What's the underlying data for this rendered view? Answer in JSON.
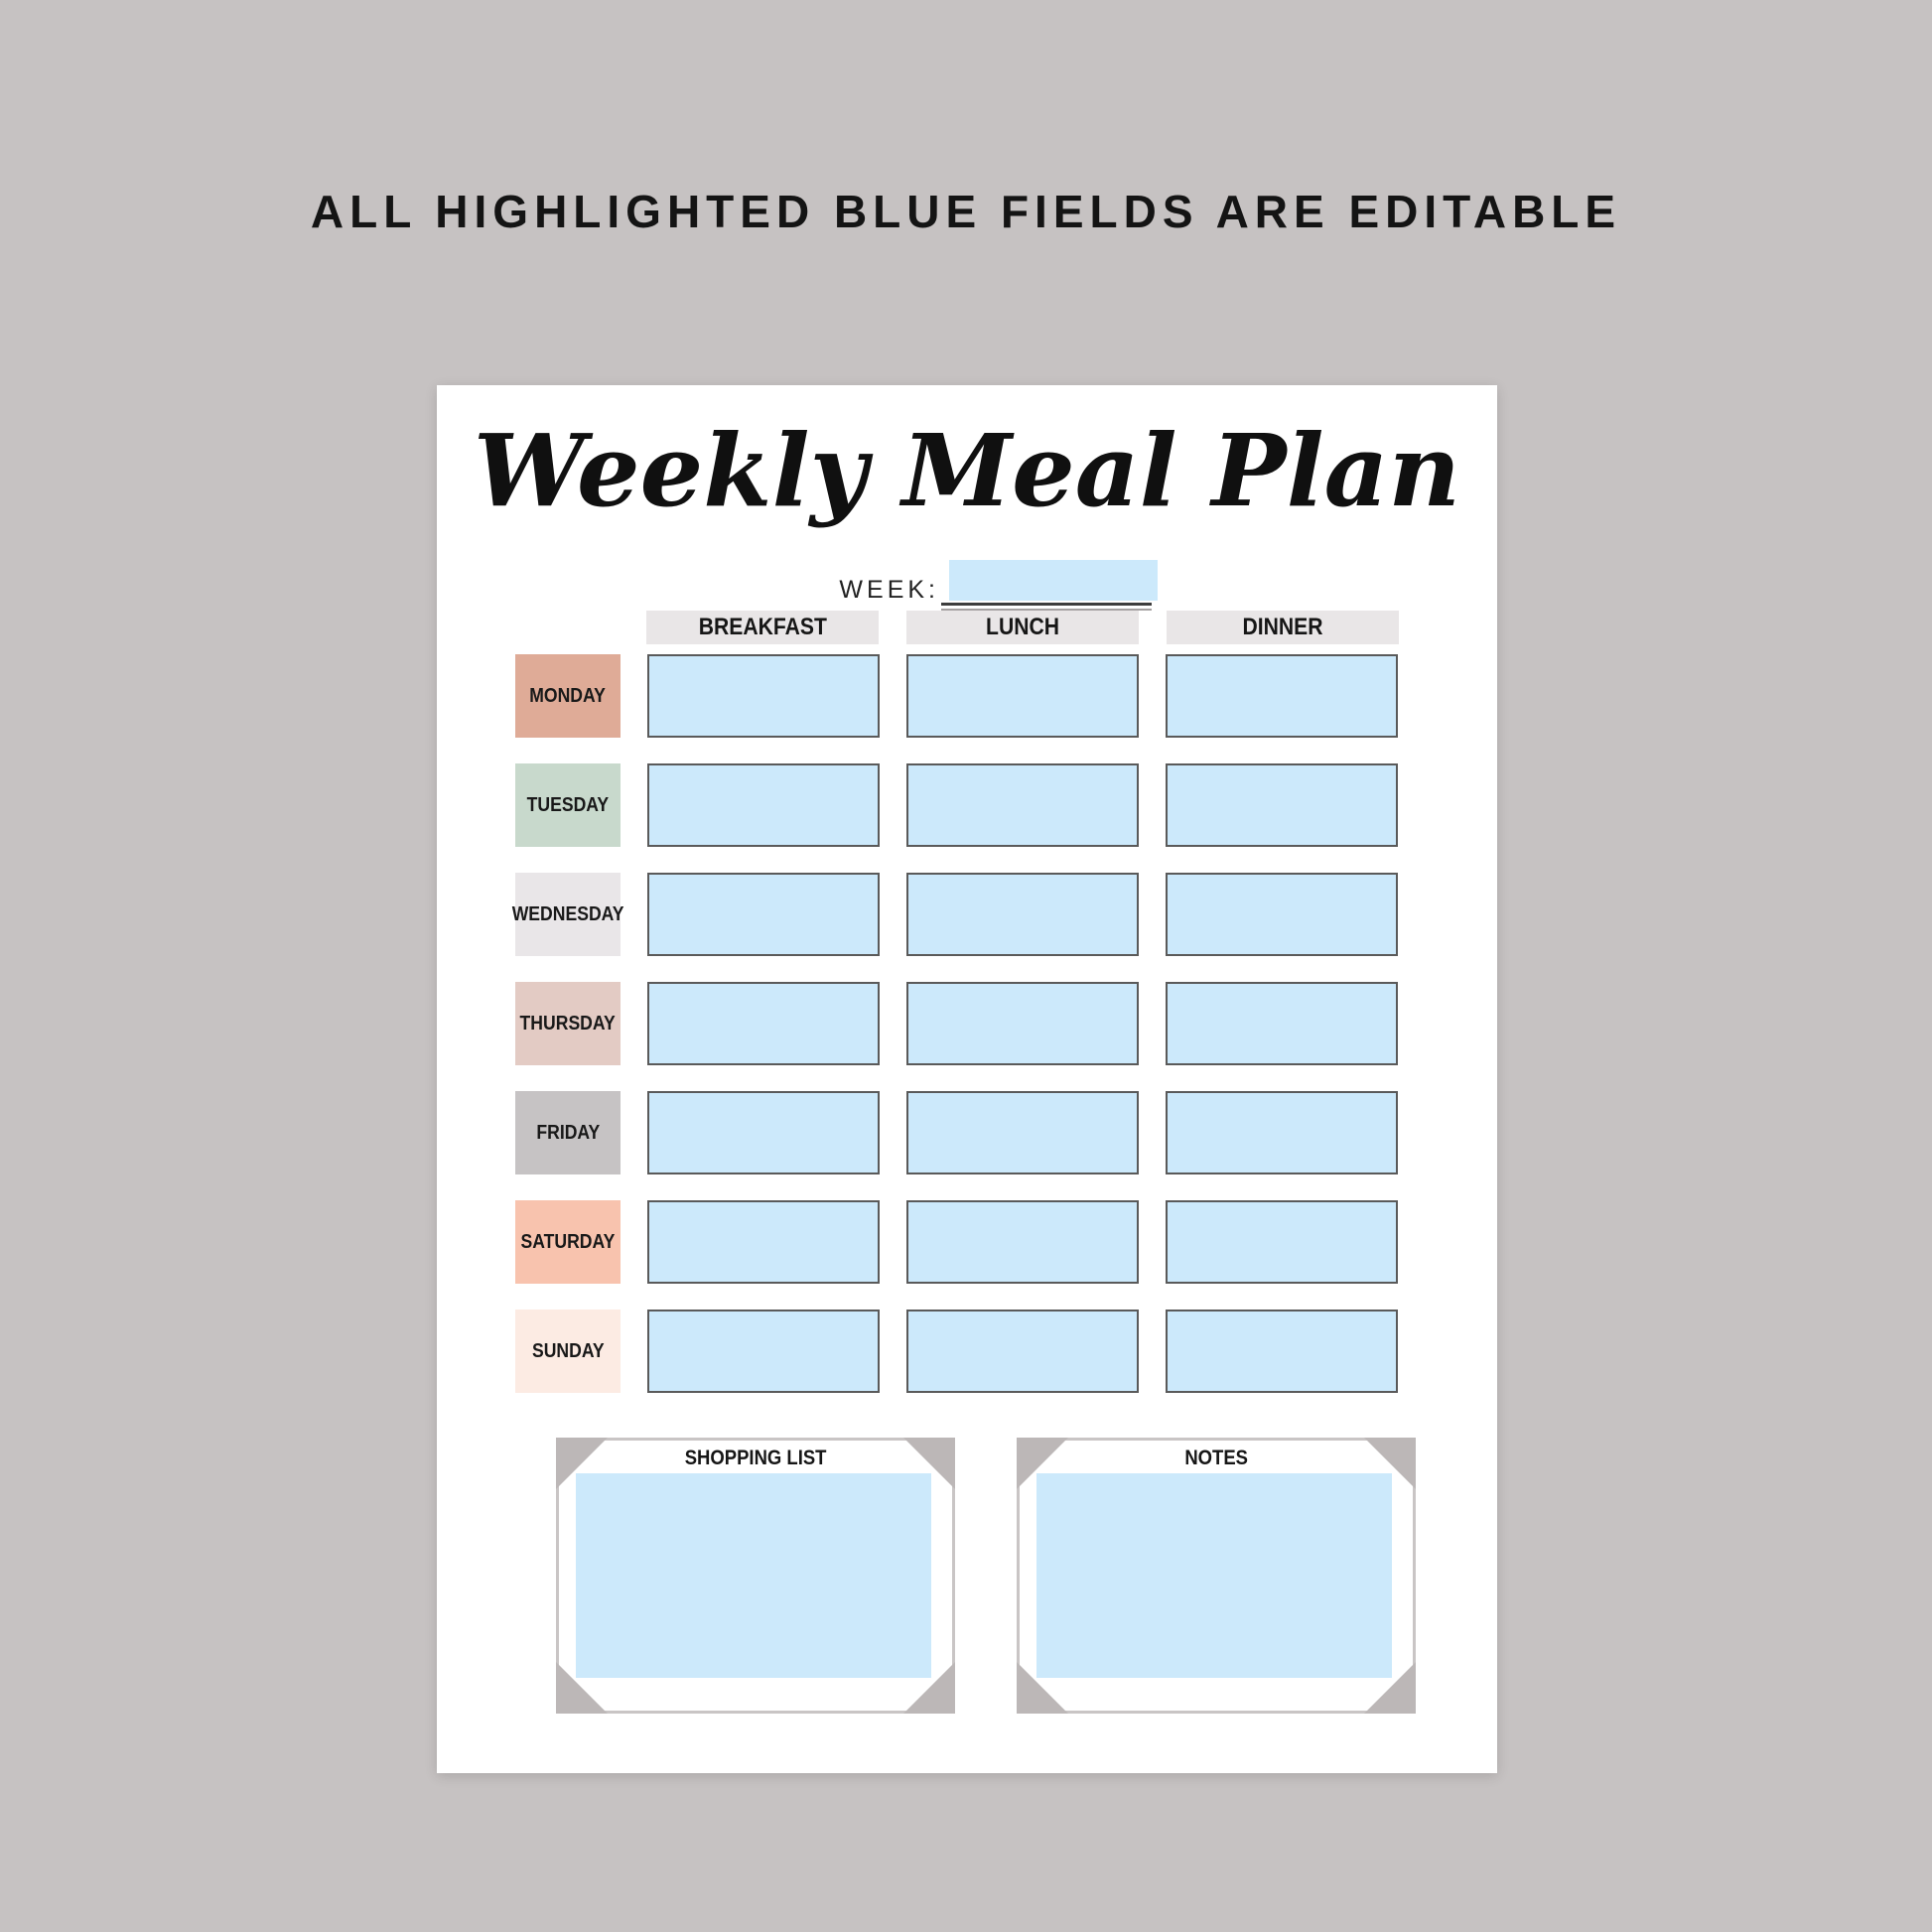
{
  "banner": {
    "text": "ALL HIGHLIGHTED BLUE FIELDS ARE EDITABLE"
  },
  "page": {
    "title": "Weekly Meal Plan",
    "week": {
      "label": "WEEK:",
      "value": ""
    },
    "columns": [
      "BREAKFAST",
      "LUNCH",
      "DINNER"
    ],
    "days": [
      {
        "label": "MONDAY",
        "color": "#dfab97"
      },
      {
        "label": "TUESDAY",
        "color": "#c8d9cc"
      },
      {
        "label": "WEDNESDAY",
        "color": "#e9e6e8"
      },
      {
        "label": "THURSDAY",
        "color": "#e3cbc4"
      },
      {
        "label": "FRIDAY",
        "color": "#c6c3c4"
      },
      {
        "label": "SATURDAY",
        "color": "#f8c3ae"
      },
      {
        "label": "SUNDAY",
        "color": "#fcebe3"
      }
    ],
    "sections": [
      {
        "title": "SHOPPING LIST"
      },
      {
        "title": "NOTES"
      }
    ],
    "colors": {
      "editable_blue": "#cce9fb",
      "header_gray": "#e9e6e7",
      "canvas_gray": "#c6c2c2",
      "frame_gray": "#bcb7b7",
      "cell_border": "#5a5a5a"
    }
  }
}
